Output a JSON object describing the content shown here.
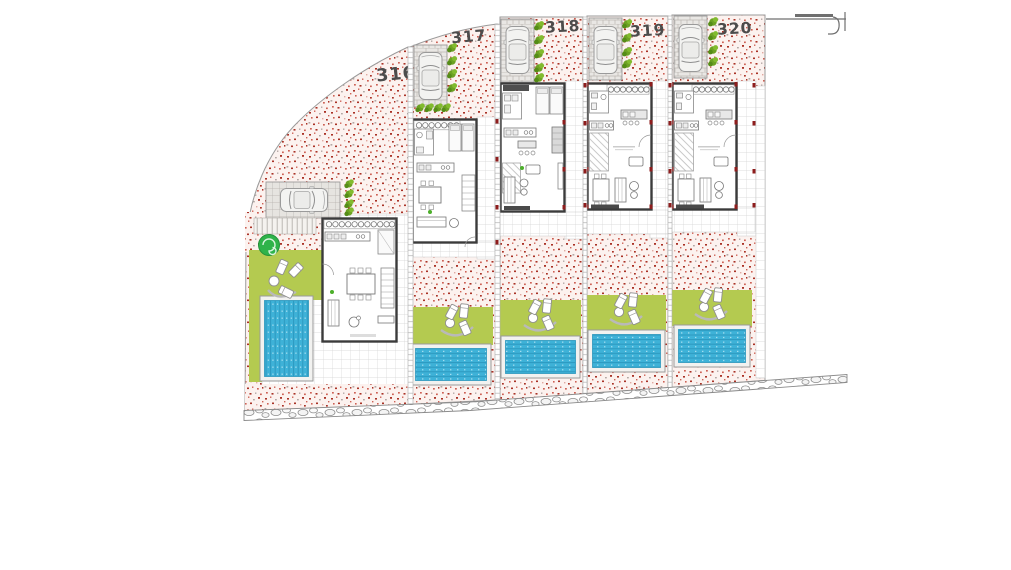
{
  "site_plan": {
    "title": "Residential site plan – five plots with villas and pools",
    "plots": [
      {
        "id": "plot-316",
        "number": "316",
        "pool_orientation": "vertical",
        "elements": [
          "gravel-ground",
          "parking-pad",
          "car",
          "access-ramp",
          "tree",
          "hedge-strip",
          "lawn",
          "sun-loungers",
          "pool",
          "house-floorplan",
          "terrace-tiles"
        ]
      },
      {
        "id": "plot-317",
        "number": "317",
        "pool_orientation": "horizontal",
        "elements": [
          "gravel-ground",
          "driveway",
          "car",
          "hedge-strip",
          "house-floorplan",
          "terrace-tiles",
          "lawn",
          "sun-loungers",
          "pool"
        ]
      },
      {
        "id": "plot-318",
        "number": "318",
        "pool_orientation": "horizontal",
        "elements": [
          "gravel-ground",
          "driveway",
          "car",
          "hedge-strip",
          "house-floorplan",
          "terrace-tiles",
          "lawn",
          "sun-loungers",
          "pool"
        ]
      },
      {
        "id": "plot-319",
        "number": "319",
        "pool_orientation": "horizontal",
        "elements": [
          "gravel-ground",
          "driveway",
          "car",
          "hedge-strip",
          "house-floorplan",
          "terrace-tiles",
          "lawn",
          "sun-loungers",
          "pool"
        ]
      },
      {
        "id": "plot-320",
        "number": "320",
        "pool_orientation": "horizontal",
        "elements": [
          "gravel-ground",
          "driveway",
          "car",
          "hedge-strip",
          "house-floorplan",
          "terrace-tiles",
          "lawn",
          "sun-loungers",
          "pool"
        ]
      }
    ],
    "shared_features": {
      "left_boundary": "curved site boundary",
      "bottom_path": "rubble stone footpath",
      "street_edge": "street curb detail at top right",
      "plot_dividers": "stepped white walkways between plots"
    }
  },
  "colors": {
    "gravel_base": "#fcf2ef",
    "gravel_dot_dark": "#a93226",
    "gravel_dot_mid": "#cd6155",
    "gravel_dot_gray": "#b3a7a4",
    "lawn": "#b4ca50",
    "pool": "#3eb2d8",
    "pool_lane": "#2b96bd",
    "bush": "#6da223",
    "tree": "#2eb34a",
    "wall": "#3b3b3b",
    "tile_line": "#d4d4d4",
    "paving": "#e9e7e4",
    "column_red": "#8e1d1d",
    "label": "#4c4c4c",
    "boundary": "#9a9a9a"
  }
}
